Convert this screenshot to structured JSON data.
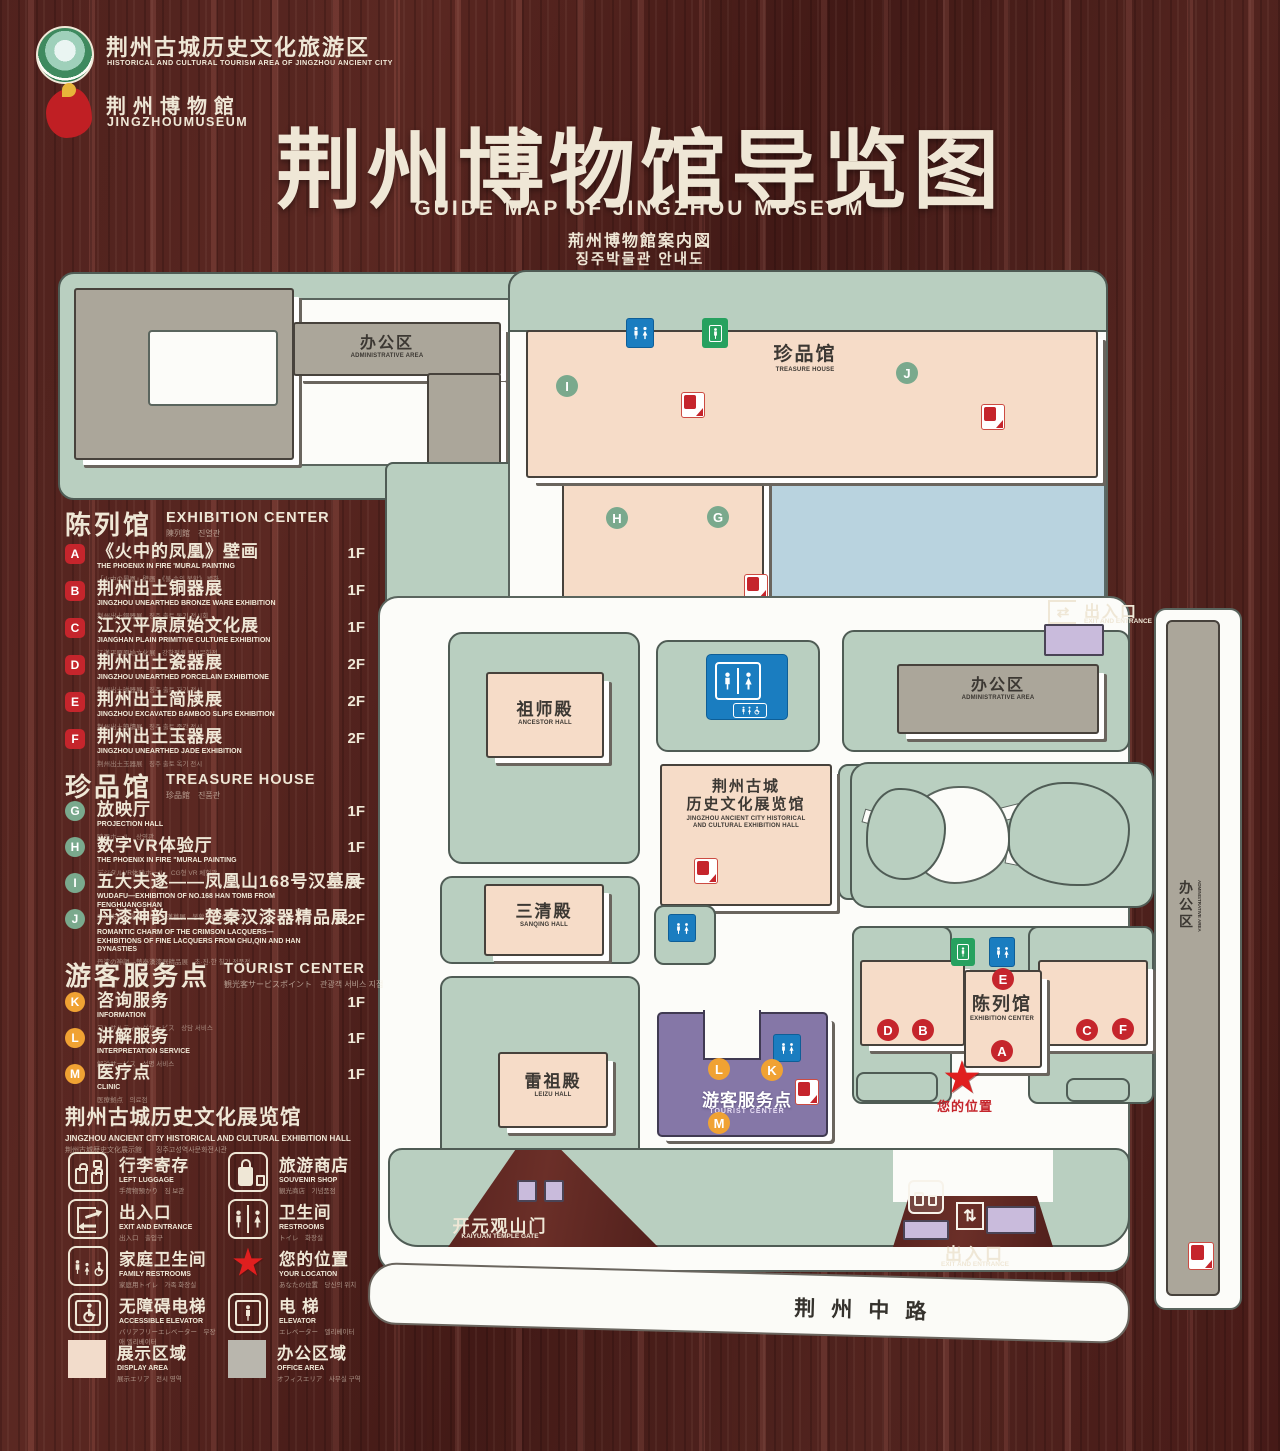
{
  "header": {
    "logo_tourism": {
      "zh": "荆州古城历史文化旅游区",
      "en": "HISTORICAL AND CULTURAL TOURISM AREA OF JINGZHOU ANCIENT CITY"
    },
    "logo_museum": {
      "zh": "荆州博物館",
      "en": "JINGZHOUMUSEUM"
    },
    "title": {
      "zh": "荆州博物馆导览图",
      "en": "GUIDE MAP OF JINGZHOU MUSEUM",
      "ja": "荊州博物館案内図",
      "ko": "징주박물관 안내도"
    }
  },
  "legend": {
    "sections": [
      {
        "title_zh": "陈列馆",
        "title_en": "EXHIBITION CENTER",
        "title_sub": "陳列館　진열관",
        "items": [
          {
            "letter": "A",
            "zh": "《火中的凤凰》壁画",
            "en": "THE PHOENIX IN FIRE 'MURAL PAINTING",
            "sub": "「火中の鳳凰」壁画　《불 속의 봉황》 벽화",
            "floor": "1F"
          },
          {
            "letter": "B",
            "zh": "荆州出土铜器展",
            "en": "JINGZHOU UNEARTHED BRONZE WARE EXHIBITION",
            "sub": "荆州出土銅器展　징주 출토 동기 전시회",
            "floor": "1F"
          },
          {
            "letter": "C",
            "zh": "江汉平原原始文化展",
            "en": "JIANGHAN PLAIN PRIMITIVE CULTURE EXHIBITION",
            "sub": "江漢平原原始文化展　강한평원 원시문화전",
            "floor": "1F"
          },
          {
            "letter": "D",
            "zh": "荆州出土瓷器展",
            "en": "JINGZHOU UNEARTHED PORCELAIN EXHIBITIONE",
            "sub": "荆州出土磁器展　징주 출토 자기 전시",
            "floor": "2F"
          },
          {
            "letter": "E",
            "zh": "荆州出土简牍展",
            "en": "JINGZHOU EXCAVATED BAMBOO SLIPS EXHIBITION",
            "sub": "荆州出土簡牘展　징주 출토 죽간 전시",
            "floor": "2F"
          },
          {
            "letter": "F",
            "zh": "荆州出土玉器展",
            "en": "JINGZHOU UNEARTHED JADE EXHIBITION",
            "sub": "荆州出土玉器展　징주 출토 옥기 전시",
            "floor": "2F"
          }
        ]
      },
      {
        "title_zh": "珍品馆",
        "title_en": "TREASURE HOUSE",
        "title_sub": "珍品館　진품관",
        "items": [
          {
            "letter": "G",
            "zh": "放映厅",
            "en": "PROJECTION HALL",
            "sub": "映画ホール　상영관",
            "floor": "1F"
          },
          {
            "letter": "H",
            "zh": "数字VR体验厅",
            "en": "THE PHOENIX IN FIRE \"MURAL PAINTING",
            "sub": "デジタルVR体験ホール　CG형 VR 체험관",
            "floor": "1F"
          },
          {
            "letter": "I",
            "zh": "五大夫遂——凤凰山168号汉墓展",
            "en": "WUDAFU—EXHIBITION OF NO.168 HAN TOMB FROM FENGHUANGSHAN",
            "sub": "五大夫遂—鳳凰山168号漢墓展　봉황산 168호 한묘전",
            "floor": "2F"
          },
          {
            "letter": "J",
            "zh": "丹漆神韵——楚秦汉漆器精品展",
            "en": "ROMANTIC CHARM OF THE CRIMSON LACQUERS— EXHIBITIONS OF FINE LACQUERS FROM CHU,QIN AND HAN DYNASTIES",
            "sub": "丹漆の神韻—楚秦漢漆器精品展　초·진·한 칠기 정품전",
            "floor": "1-2F"
          }
        ]
      },
      {
        "title_zh": "游客服务点",
        "title_en": "TOURIST CENTER",
        "title_sub": "観光客サービスポイント　관광객 서비스 지점",
        "items": [
          {
            "letter": "K",
            "zh": "咨询服务",
            "en": "INFORMATION",
            "sub": "コンサルティングサービス　상담 서비스",
            "floor": "1F"
          },
          {
            "letter": "L",
            "zh": "讲解服务",
            "en": "INTERPRETATION SERVICE",
            "sub": "解説サービス　설명 서비스",
            "floor": "1F"
          },
          {
            "letter": "M",
            "zh": "医疗点",
            "en": "CLINIC",
            "sub": "医療拠点　의료점",
            "floor": "1F"
          }
        ]
      }
    ],
    "hall_note": {
      "zh": "荆州古城历史文化展览馆",
      "en": "JINGZHOU ANCIENT CITY HISTORICAL AND CULTURAL EXHIBITION HALL",
      "sub": "荆州古城歴史文化展示館　　징주고성역사문화전시관"
    },
    "icons": [
      {
        "zh": "行李寄存",
        "en": "LEFT LUGGAGE",
        "sub": "手荷物預かり　짐 보관"
      },
      {
        "zh": "旅游商店",
        "en": "SOUVENIR SHOP",
        "sub": "観光商店　기념품점"
      },
      {
        "zh": "出入口",
        "en": "EXIT AND ENTRANCE",
        "sub": "出入口　출입구"
      },
      {
        "zh": "卫生间",
        "en": "RESTROOMS",
        "sub": "トイレ　화장실"
      },
      {
        "zh": "家庭卫生间",
        "en": "FAMILY RESTROOMS",
        "sub": "家庭用トイレ　가족 화장실"
      },
      {
        "zh": "您的位置",
        "en": "YOUR LOCATION",
        "sub": "あなたの位置　당신의 위치"
      },
      {
        "zh": "无障碍电梯",
        "en": "ACCESSIBLE ELEVATOR",
        "sub": "バリアフリーエレベーター　무장애 엘리베이터"
      },
      {
        "zh": "电 梯",
        "en": "ELEVATOR",
        "sub": "エレベーター　엘리베이터"
      },
      {
        "zh": "展示区域",
        "en": "DISPLAY AREA",
        "sub": "展示エリア　전시 영역"
      },
      {
        "zh": "办公区域",
        "en": "OFFICE AREA",
        "sub": "オフィスエリア　사무실 구역"
      }
    ]
  },
  "map": {
    "labels": {
      "admin_zh": "办公区",
      "admin_en": "ADMINISTRATIVE AREA",
      "treasure_zh": "珍品馆",
      "treasure_en": "TREASURE HOUSE",
      "ancestor_zh": "祖师殿",
      "ancestor_en": "ANCESTOR HALL",
      "sanqing_zh": "三清殿",
      "sanqing_en": "SANQING HALL",
      "leizu_zh": "雷祖殿",
      "leizu_en": "LEIZU HALL",
      "hall_zh1": "荆州古城",
      "hall_zh2": "历史文化展览馆",
      "hall_en1": "JINGZHOU ANCIENT CITY HISTORICAL",
      "hall_en2": "AND CULTURAL EXHIBITION HALL",
      "exhibition_zh": "陈列馆",
      "exhibition_en": "EXHIBITION CENTER",
      "tourist_zh": "游客服务点",
      "tourist_en": "TOURIST CENTER",
      "gate_zh": "开元观山门",
      "gate_en": "KAIYUAN TEMPLE GATE",
      "exit_zh": "出入口",
      "exit_en": "EXIT AND ENTRANCE",
      "road": "荆州中路",
      "location_zh": "您的位置"
    },
    "markers": {
      "A": "A",
      "B": "B",
      "C": "C",
      "D": "D",
      "E": "E",
      "F": "F",
      "G": "G",
      "H": "H",
      "I": "I",
      "J": "J",
      "K": "K",
      "L": "L",
      "M": "M"
    }
  },
  "glyphs": {
    "star": "★",
    "exit_h": "⇄",
    "exit_v": "⇅"
  },
  "colors": {
    "wood": "#5a241f",
    "map_green": "#b9cfc0",
    "building_pink": "#f6dcc8",
    "building_gray": "#aba69a",
    "water": "#b9d3df",
    "tourist_purple": "#8577a7",
    "gate_purple": "#c9bbdc",
    "marker_red": "#c5252c",
    "marker_green": "#7aa98d",
    "marker_orange": "#f0a233",
    "restroom_blue": "#1a7dc0",
    "elevator_green": "#27a15f",
    "star_red": "#e01f1f",
    "cream": "#efe7d6"
  }
}
